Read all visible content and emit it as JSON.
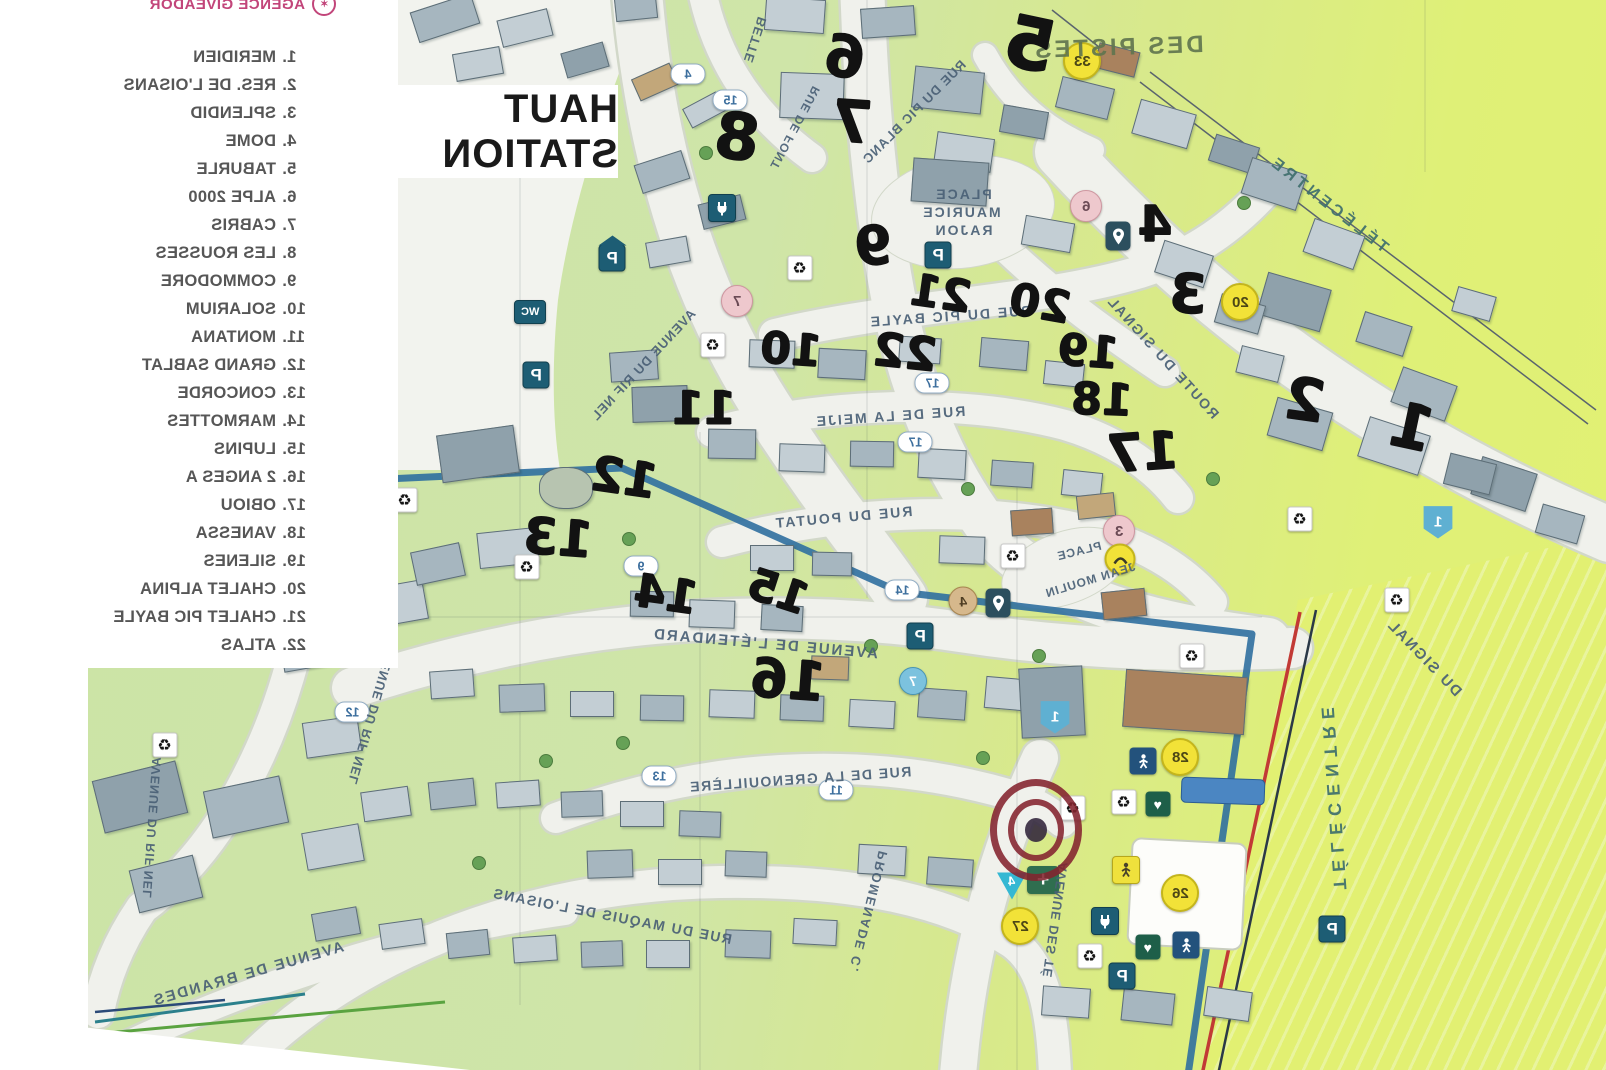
{
  "title": "HAUT STATION",
  "legend": {
    "agency": "AGENCE GIVEADOR",
    "items": [
      [
        "1.",
        "MERIDIEN"
      ],
      [
        "2.",
        "RES. DE L'OISANS"
      ],
      [
        "3.",
        "SPLENDID"
      ],
      [
        "4.",
        "DOME"
      ],
      [
        "5.",
        "TABURLE"
      ],
      [
        "6.",
        "ALPE 2000"
      ],
      [
        "7.",
        "CABRIS"
      ],
      [
        "8.",
        "LES ROUSSES"
      ],
      [
        "9.",
        "COMMODORE"
      ],
      [
        "10.",
        "SOLARIUM"
      ],
      [
        "11.",
        "MONTANA"
      ],
      [
        "12.",
        "GRAND SABLAT"
      ],
      [
        "13.",
        "CONCORDE"
      ],
      [
        "14.",
        "MARMOTTES"
      ],
      [
        "15.",
        "LUPINS"
      ],
      [
        "16.",
        "2 ANGES A"
      ],
      [
        "17.",
        "OBIOU"
      ],
      [
        "18.",
        "VANESSA"
      ],
      [
        "19.",
        "SILENES"
      ],
      [
        "20.",
        "CHALET ALPINA"
      ],
      [
        "21.",
        "CHALET PIC BAYLE"
      ],
      [
        "22.",
        "ATLAS"
      ]
    ]
  },
  "map": {
    "street_labels": [
      [
        "DES PISTES",
        1118,
        48,
        -2,
        24,
        3
      ],
      [
        "TÉLÉCENTRE",
        1328,
        205,
        38,
        16,
        4
      ],
      [
        "TÉLÉCENTRE",
        1333,
        795,
        86,
        18,
        7
      ],
      [
        "DU SIGNAL",
        1424,
        658,
        46,
        15,
        2
      ],
      [
        "BETTE",
        755,
        40,
        -72,
        13,
        1
      ],
      [
        "RUE DE FONT",
        795,
        128,
        -62,
        12,
        1
      ],
      [
        "RUE DU PIC BLANC",
        914,
        112,
        -45,
        13,
        1
      ],
      [
        "PLACE",
        963,
        194,
        0,
        14,
        2
      ],
      [
        "MAURICE",
        961,
        212,
        0,
        14,
        2
      ],
      [
        "RAJON",
        963,
        230,
        0,
        14,
        2
      ],
      [
        "RUE DU PIC BAYLE",
        950,
        316,
        -4,
        14,
        2
      ],
      [
        "ROUTE DU SIGNAL",
        1163,
        357,
        48,
        14,
        2
      ],
      [
        "RUE DE LA MEIJE",
        890,
        416,
        -4,
        14,
        2
      ],
      [
        "AVENUE DU RIF NEL",
        643,
        365,
        -47,
        13,
        1
      ],
      [
        "RUE DU POUTAT",
        843,
        517,
        -5,
        14,
        2
      ],
      [
        "PLACE",
        1079,
        551,
        -14,
        12,
        1
      ],
      [
        "JEAN MOULIN",
        1090,
        580,
        -17,
        12,
        1
      ],
      [
        "AVENUE DE L'ÉTENDARD",
        765,
        644,
        5,
        15,
        2
      ],
      [
        "RUE DE LA GRENOUILLÈRE",
        800,
        779,
        -4,
        14,
        1.5
      ],
      [
        "PROMENADE C.",
        868,
        912,
        -76,
        13,
        2
      ],
      [
        "RUE DU MAQUIS DE L'OISANS",
        612,
        916,
        11,
        14,
        1.5
      ],
      [
        "AVENUE DE BRANDES",
        248,
        974,
        -16,
        15,
        2
      ],
      [
        "AVENUE DU RIF NEL",
        372,
        714,
        -74,
        13,
        1
      ],
      [
        "AVENUE DU RIF NEL",
        152,
        828,
        -86,
        12.5,
        1
      ],
      [
        "AVENUE DES TÉ",
        1055,
        920,
        -82,
        13,
        1
      ]
    ],
    "handwritten_numbers": [
      [
        "6",
        845,
        57,
        58,
        8
      ],
      [
        "5",
        1030,
        44,
        72,
        12
      ],
      [
        "7",
        852,
        122,
        58,
        4
      ],
      [
        "8",
        737,
        138,
        64,
        8
      ],
      [
        "9",
        873,
        246,
        54,
        -6
      ],
      [
        "4",
        1155,
        224,
        50,
        0
      ],
      [
        "3",
        1188,
        294,
        54,
        4
      ],
      [
        "21",
        941,
        294,
        44,
        8
      ],
      [
        "20",
        1040,
        304,
        44,
        10
      ],
      [
        "10",
        791,
        350,
        44,
        4
      ],
      [
        "22",
        905,
        352,
        46,
        6
      ],
      [
        "19",
        1088,
        352,
        44,
        4
      ],
      [
        "18",
        1102,
        400,
        44,
        2
      ],
      [
        "17",
        1143,
        453,
        52,
        -4
      ],
      [
        "2",
        1305,
        400,
        58,
        8
      ],
      [
        "1",
        1412,
        427,
        62,
        12
      ],
      [
        "11",
        704,
        408,
        46,
        0
      ],
      [
        "12",
        624,
        478,
        48,
        8
      ],
      [
        "13",
        558,
        538,
        50,
        4
      ],
      [
        "14",
        666,
        594,
        46,
        8
      ],
      [
        "15",
        778,
        592,
        44,
        18
      ],
      [
        "16",
        788,
        680,
        54,
        4
      ]
    ],
    "badges": [
      [
        "proof",
        "P",
        612,
        258
      ],
      [
        "p",
        "P",
        536,
        375
      ],
      [
        "p",
        "P",
        938,
        255
      ],
      [
        "p",
        "P",
        920,
        636
      ],
      [
        "p",
        "P",
        1122,
        976
      ],
      [
        "p",
        "P",
        1332,
        929
      ],
      [
        "wc",
        "WC",
        530,
        312
      ],
      [
        "plug",
        "",
        722,
        208
      ],
      [
        "plug",
        "",
        1105,
        921
      ],
      [
        "rec",
        "♻",
        800,
        268
      ],
      [
        "rec",
        "♻",
        713,
        345
      ],
      [
        "rec",
        "♻",
        405,
        500
      ],
      [
        "rec",
        "♻",
        527,
        567
      ],
      [
        "rec",
        "♻",
        1013,
        556
      ],
      [
        "rec",
        "♻",
        1192,
        656
      ],
      [
        "rec",
        "♻",
        1073,
        808
      ],
      [
        "rec",
        "♻",
        1124,
        802
      ],
      [
        "rec",
        "♻",
        1300,
        519
      ],
      [
        "rec",
        "♻",
        1397,
        600
      ],
      [
        "rec",
        "♻",
        165,
        745
      ],
      [
        "rec",
        "♻",
        1090,
        956
      ],
      [
        "heart",
        "♥",
        1158,
        804
      ],
      [
        "heart",
        "♥",
        1148,
        947
      ],
      [
        "cross",
        "+",
        1043,
        880
      ],
      [
        "slide",
        "",
        1143,
        761
      ],
      [
        "slide",
        "",
        1186,
        945
      ],
      [
        "pin",
        "",
        1118,
        236
      ],
      [
        "pin",
        "",
        998,
        603
      ],
      [
        "persony",
        "",
        1126,
        870
      ],
      [
        "tri",
        "4",
        1012,
        886
      ],
      [
        "shield",
        "1",
        1055,
        717
      ],
      [
        "shield",
        "1",
        1438,
        522
      ],
      [
        "pill",
        "4",
        688,
        74
      ],
      [
        "pill",
        "15",
        730,
        100
      ],
      [
        "pill",
        "17",
        932,
        383
      ],
      [
        "pill",
        "17",
        915,
        442
      ],
      [
        "pill",
        "14",
        902,
        590
      ],
      [
        "pill",
        "9",
        641,
        566
      ],
      [
        "pill",
        "12",
        352,
        712
      ],
      [
        "pill",
        "11",
        836,
        790
      ],
      [
        "pill",
        "13",
        659,
        776
      ],
      [
        "cpink",
        "6",
        1086,
        206
      ],
      [
        "cpink",
        "7",
        737,
        301
      ],
      [
        "cpink",
        "3",
        1119,
        531
      ],
      [
        "cblue",
        "7",
        913,
        681
      ],
      [
        "ctan",
        "4",
        963,
        601
      ],
      [
        "cyel",
        "33",
        1082,
        61
      ],
      [
        "cyel",
        "20",
        1240,
        302
      ],
      [
        "cyel",
        "26",
        1180,
        893
      ],
      [
        "cyel",
        "27",
        1020,
        926
      ],
      [
        "cyel",
        "28",
        1180,
        757
      ],
      [
        "ymark",
        "",
        1120,
        559
      ]
    ],
    "target_marker": {
      "x": 1036,
      "y": 830
    },
    "colors": {
      "legend_accent": "#c2457a",
      "street_label": "#4a6076",
      "marker_ink": "#121212",
      "river": "#2f6fa0",
      "piste_boundary_red": "#c23a35",
      "road": "#f0f1ec",
      "badge_teal": "#1d5d74",
      "badge_green": "#1e5f49",
      "badge_yellow": "#f2e238",
      "badge_pink": "#eec8cd"
    }
  }
}
